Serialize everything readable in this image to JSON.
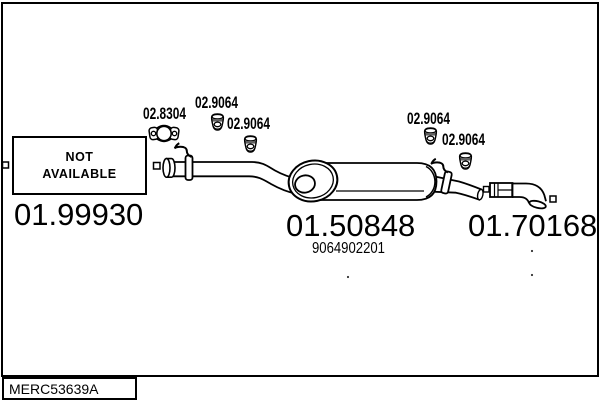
{
  "drawing": {
    "catalog_code": "MERC53639A",
    "not_available_box": {
      "line1": "NOT",
      "line2": "AVAILABLE"
    },
    "part_numbers": {
      "front_pipe": "01.99930",
      "rear_silencer": "01.50848",
      "rear_silencer_oe": "9064902201",
      "tail_pipe": "01.70168",
      "clamp": "02.8304",
      "hanger_labels": [
        "02.9064",
        "02.9064",
        "02.9064",
        "02.9064"
      ]
    },
    "icons": {
      "clamp": "exhaust-clamp-icon",
      "hanger": "rubber-hanger-icon"
    },
    "colors": {
      "line": "#000000",
      "background": "#ffffff"
    }
  }
}
